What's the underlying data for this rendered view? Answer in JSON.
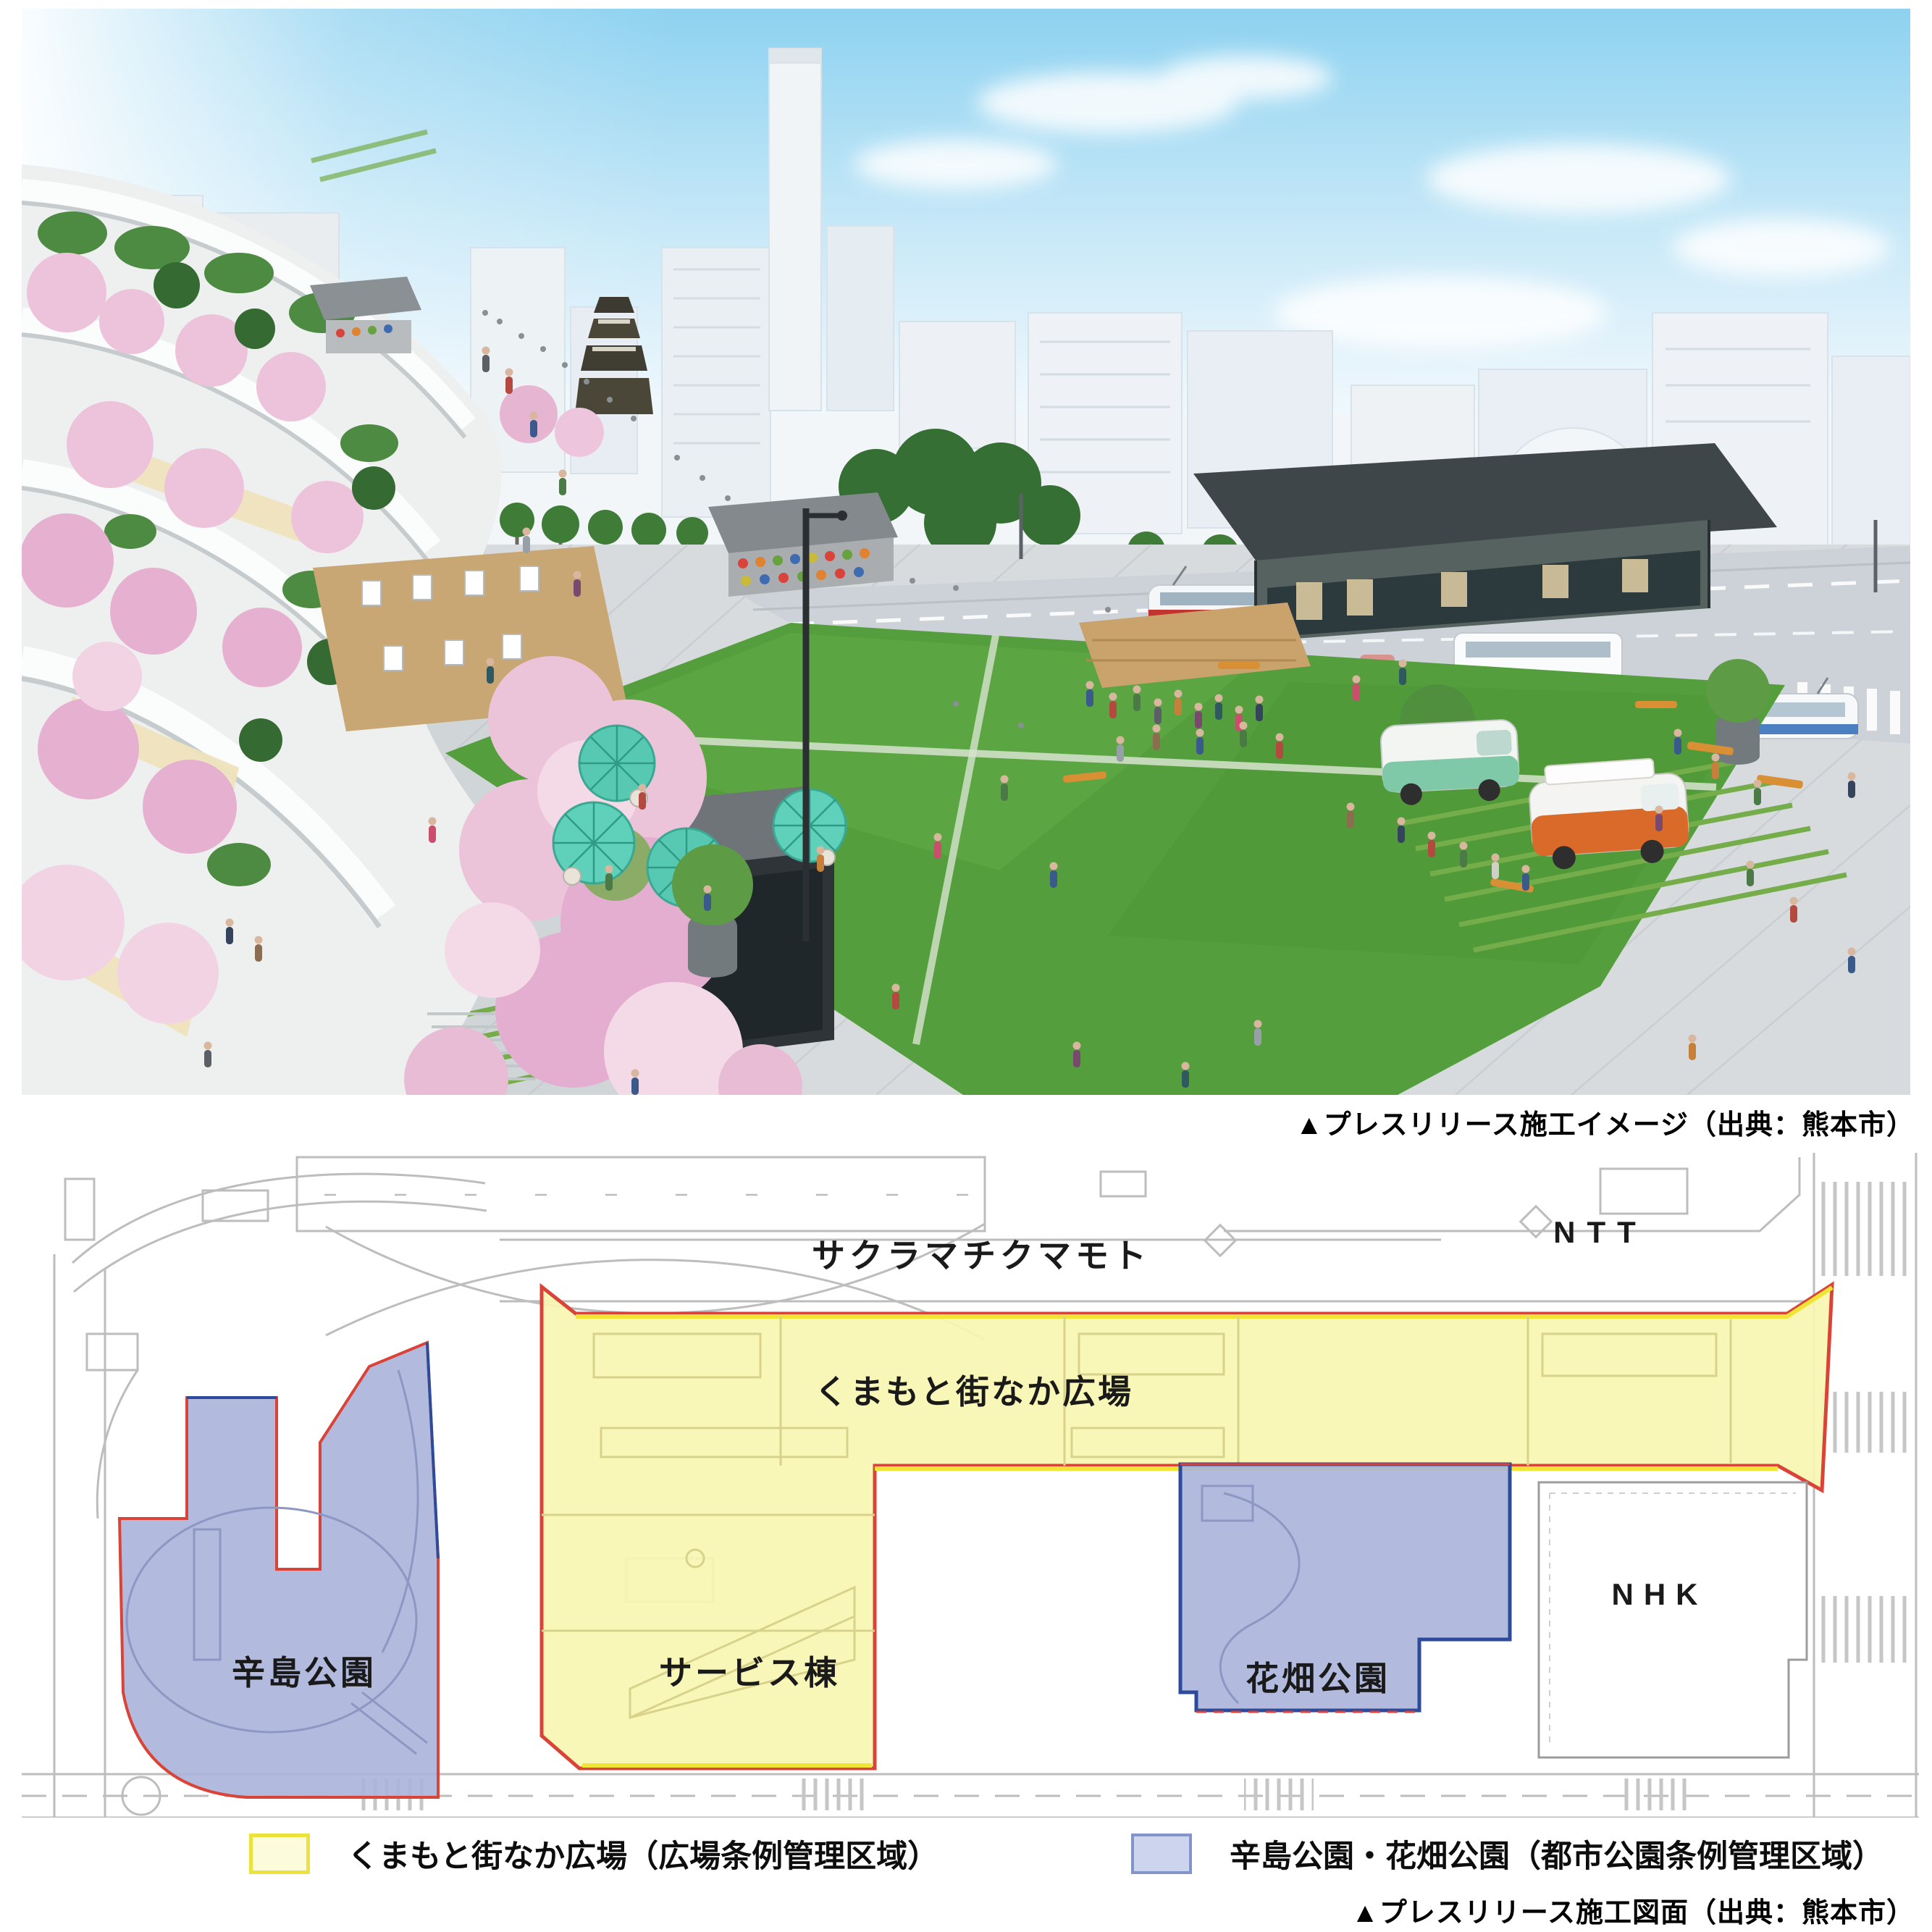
{
  "figure_top": {
    "caption": "▲プレスリリース施工イメージ（出典：熊本市）",
    "scene": "kumamoto-machinaka-plaza-rendering",
    "scene_colors": {
      "sky": "#8ed2f0",
      "lawn": "#559e3d",
      "paving": "#d7dbde",
      "cherry_blossom": "#e9bcd6",
      "umbrella": "#57c9b2",
      "pavilion_roof": "#3f4649",
      "food_truck_orange": "#d96a2a",
      "food_truck_green": "#7fc9a8"
    }
  },
  "site_plan": {
    "caption": "▲プレスリリース施工図面（出典：熊本市）",
    "labels": {
      "sakuramachi_kumamoto": "サクラマチクマモト",
      "ntt": "NTT",
      "machinaka_plaza": "くまもと街なか広場",
      "karashima_park": "辛島公園",
      "service_building": "サービス棟",
      "hanabatake_park": "花畑公園",
      "nhk": "NHK"
    },
    "zones": {
      "plaza": {
        "name": "くまもと街なか広場",
        "fill": "#f8f6b2",
        "border_red": "#d94338",
        "border_yellow": "#f2e435"
      },
      "karashima": {
        "name": "辛島公園",
        "fill": "#aab3d9",
        "border": "#d94338"
      },
      "hanabatake": {
        "name": "花畑公園",
        "fill": "#aab3d9",
        "border": "#2d4a9b"
      }
    }
  },
  "legend": {
    "items": [
      {
        "label": "くまもと街なか広場（広場条例管理区域）",
        "swatch_fill": "#fcfbdb",
        "swatch_border": "#ece23c"
      },
      {
        "label": "辛島公園・花畑公園（都市公園条例管理区域）",
        "swatch_fill": "#cdd4ee",
        "swatch_border": "#8294c9"
      }
    ]
  }
}
